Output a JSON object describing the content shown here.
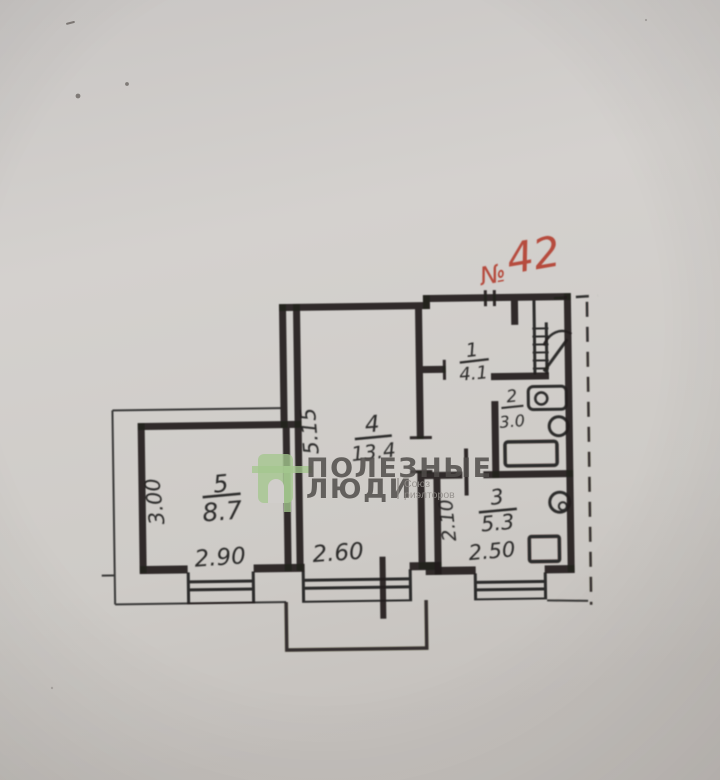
{
  "document": {
    "apartment_number_prefix": "№",
    "apartment_number": "42",
    "rooms": [
      {
        "number": "5",
        "area": "8.7"
      },
      {
        "number": "4",
        "area": "13.4"
      },
      {
        "number": "1",
        "area": "4.1"
      },
      {
        "number": "2",
        "area": "3.0"
      },
      {
        "number": "3",
        "area": "5.3"
      }
    ],
    "dimensions": {
      "room5_width": "2.90",
      "room5_depth": "3.00",
      "room4_width": "2.60",
      "room4_depth": "5.15",
      "room3_width": "2.50",
      "room3_depth": "2.10"
    },
    "watermark": {
      "title_line1": "ПОЛЕЗНЫЕ",
      "title_line2": "ЛЮДИ",
      "subtitle_line1": "Союз",
      "subtitle_line2": "риэлторов"
    },
    "colors": {
      "paper": "#d1cecb",
      "ink": "#211f1d",
      "red_ink": "#b23b2a",
      "watermark_text": "#504d4a",
      "logo_green": "#a4c78e"
    }
  }
}
